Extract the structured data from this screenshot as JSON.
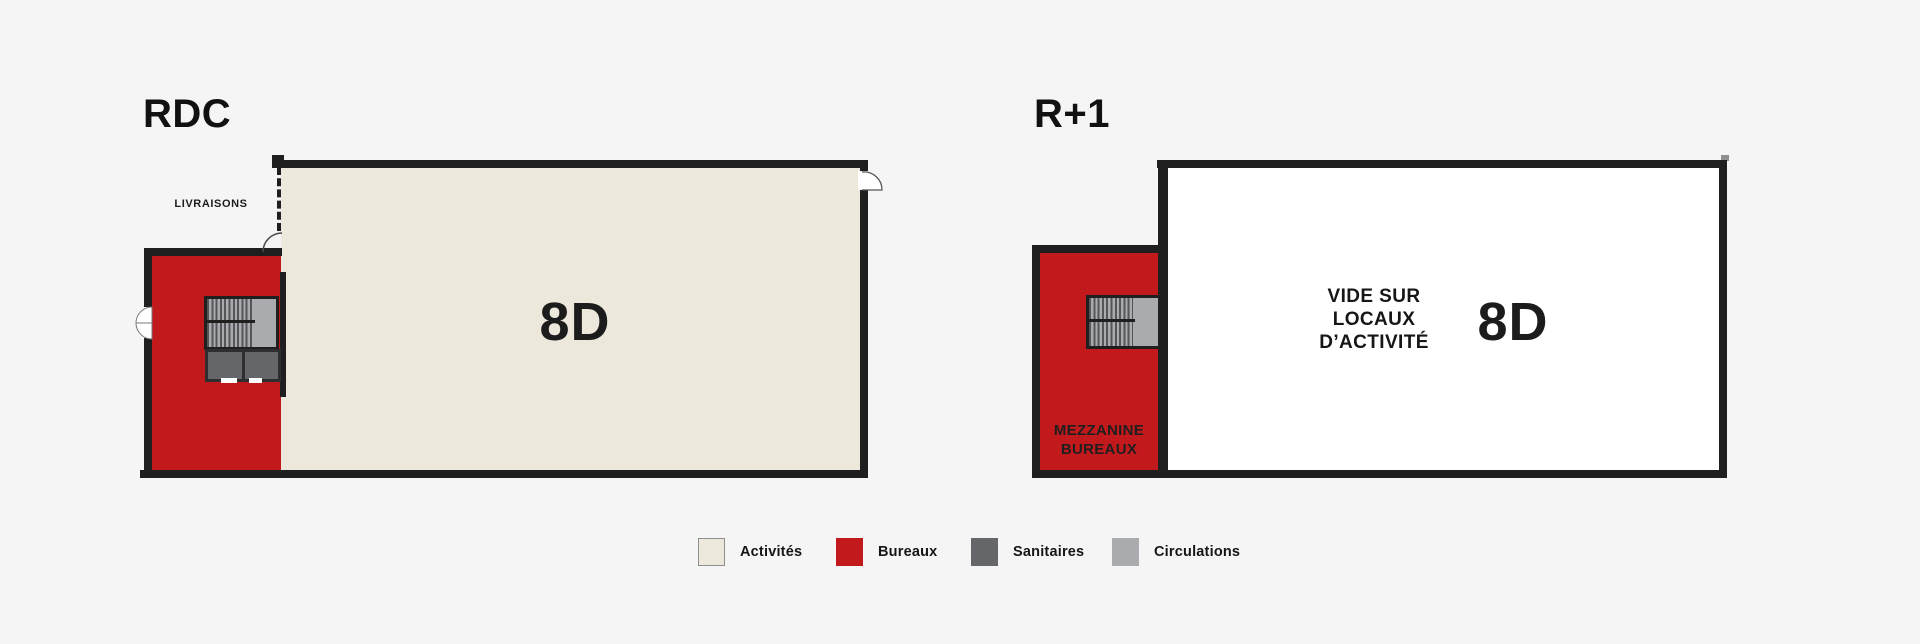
{
  "plans": {
    "rdc": {
      "title": "RDC",
      "unit_label": "8D",
      "delivery_label": "LIVRAISONS"
    },
    "r1": {
      "title": "R+1",
      "unit_label": "8D",
      "void_line1": "VIDE SUR",
      "void_line2": "LOCAUX",
      "void_line3": "D’ACTIVITÉ",
      "mezzanine_line1": "MEZZANINE",
      "mezzanine_line2": "BUREAUX"
    }
  },
  "legend": {
    "items": [
      {
        "label": "Activités",
        "color": "#ece8db"
      },
      {
        "label": "Bureaux",
        "color": "#c2191d"
      },
      {
        "label": "Sanitaires",
        "color": "#64666a"
      },
      {
        "label": "Circulations",
        "color": "#a9abae"
      }
    ]
  },
  "colors": {
    "background": "#f5f5f5",
    "wall": "#1f1f1f",
    "activity_fill": "#ece8db",
    "office_fill": "#c2191d",
    "sanitary_fill": "#64666a",
    "circulation_fill": "#a9abae"
  }
}
